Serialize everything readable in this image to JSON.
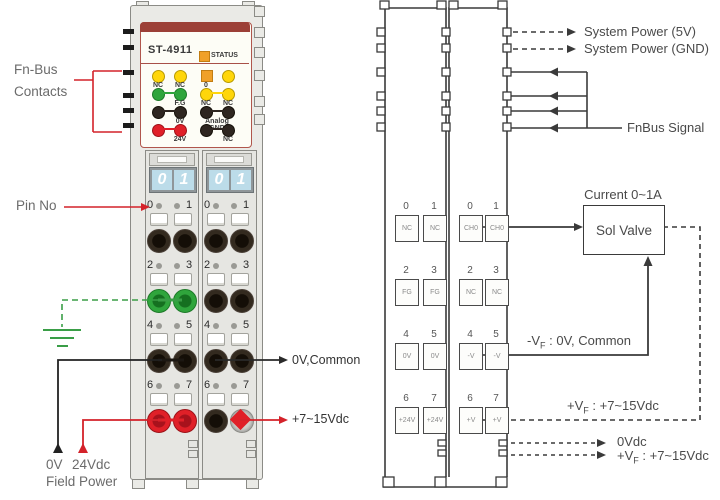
{
  "module": {
    "model": "ST-4911",
    "status": "STATUS",
    "leds": {
      "r1c1": "NC",
      "r1c2": "NC",
      "r1c3": "0",
      "r2l": "F.G",
      "r2c3": "NC",
      "r2c4": "NC",
      "r3l": "0V",
      "r3r": "Analog GND",
      "r4l": "24V",
      "r4r": "NC"
    },
    "display": [
      "0",
      "1"
    ],
    "block1_pins": [
      [
        "0",
        "1"
      ],
      [
        "2",
        "3"
      ],
      [
        "4",
        "5"
      ],
      [
        "6",
        "7"
      ]
    ],
    "block2_pins": [
      [
        "0",
        "1"
      ],
      [
        "2",
        "3"
      ],
      [
        "4",
        "5"
      ],
      [
        "6",
        "7"
      ]
    ]
  },
  "annotations": {
    "fn_bus": "Fn-Bus",
    "contacts": "Contacts",
    "pin_no": "Pin No",
    "ov_common": "0V,Common",
    "vdc_range": "+7~15Vdc",
    "field_0v": "0V",
    "field_24v": "24Vdc",
    "field_power": "Field Power"
  },
  "diagram": {
    "system_power_5v": "System Power (5V)",
    "system_power_gnd": "System Power (GND)",
    "fnbus_signal": "FnBus Signal",
    "current_rating": "Current 0~1A",
    "sol_valve": "Sol Valve",
    "neg_vf": {
      "pre": "-V",
      "sub": "F",
      "post": " : 0V, Common"
    },
    "pos_vf": {
      "pre": "+V",
      "sub": "F",
      "post": " : +7~15Vdc"
    },
    "out_0vdc": "0Vdc",
    "out_pos_vf": {
      "pre": "+V",
      "sub": "F",
      "post": " : +7~15Vdc"
    },
    "rail1": {
      "rows": [
        {
          "p": [
            "0",
            "1"
          ],
          "t": [
            "NC",
            "NC"
          ]
        },
        {
          "p": [
            "2",
            "3"
          ],
          "t": [
            "FG",
            "FG"
          ]
        },
        {
          "p": [
            "4",
            "5"
          ],
          "t": [
            "0V",
            "0V"
          ]
        },
        {
          "p": [
            "6",
            "7"
          ],
          "t": [
            "+24V",
            "+24V"
          ]
        }
      ]
    },
    "rail2": {
      "rows": [
        {
          "p": [
            "0",
            "1"
          ],
          "t": [
            "CH0",
            "CH0"
          ]
        },
        {
          "p": [
            "2",
            "3"
          ],
          "t": [
            "NC",
            "NC"
          ]
        },
        {
          "p": [
            "4",
            "5"
          ],
          "t": [
            "-V",
            "-V"
          ]
        },
        {
          "p": [
            "6",
            "7"
          ],
          "t": [
            "+V",
            "+V"
          ]
        }
      ]
    }
  },
  "colors": {
    "maroon": "#9c4037",
    "status_orange": "#f0a028",
    "led_yellow": "#ffd60a",
    "led_green": "#2fa53c",
    "led_red": "#e02028",
    "wire": "#3a3a3a",
    "annotation_red": "#d4222a",
    "ground_green": "#3a9e47",
    "display_blue": "#bcdce9"
  }
}
